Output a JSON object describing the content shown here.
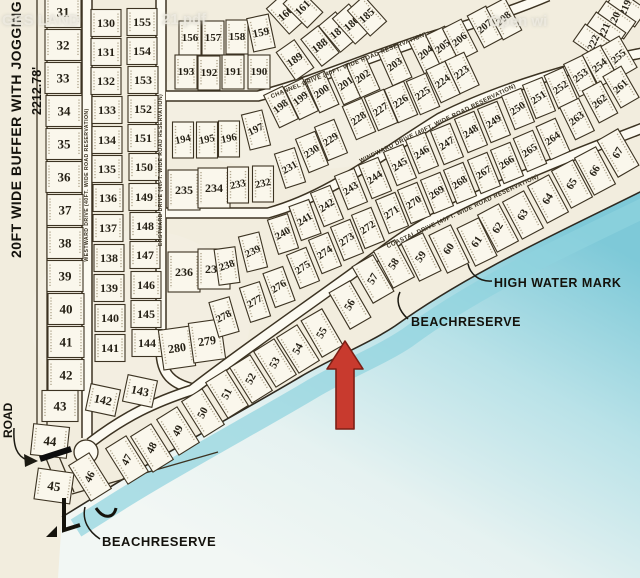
{
  "colors": {
    "paper": "#f2edde",
    "lot_fill": "#faf7ec",
    "road_fill": "#fcfaf1",
    "line": "#3c3322",
    "text": "#241f14",
    "water_deep": "#7ec9d8",
    "water_mid": "#b9e2e8",
    "water_light": "#e6f2f1",
    "water_pale": "#f2f7f4",
    "shore_band": "#8ed3de",
    "arrow_fill": "#c83a2e",
    "arrow_stroke": "#7c1f15"
  },
  "watermark": {
    "left": "GES LAND",
    "mid": "21.pdf",
    "right": "Open wi"
  },
  "labels": {
    "buffer": "20FT WIDE BUFFER WITH JOGGING T",
    "buffer_dim": "2212.78'",
    "road_left": "ROAD",
    "high_water_mark": "HIGH WATER MARK",
    "beach_reserve_right": "BEACHRESERVE",
    "beach_reserve_bottom": "BEACHRESERVE"
  },
  "roads": {
    "westward": "WESTWARD DRIVE (40FT. WIDE ROAD RESERVATION)",
    "eastward": "EASTWARD DRIVE (40FT. WIDE ROAD RESERVATION)",
    "channel": "CHANNEL DRIVE (40FT. WIDE ROAD RESERVATION)",
    "windward": "WINDWARD DRIVE (40FT. WIDE ROAD RESERVATION)",
    "coastal": "COASTAL DRIVE (40FT. WIDE ROAD RESERVATION)"
  },
  "lot_groups": [
    {
      "id": "column-west",
      "w": 36,
      "h": 31,
      "fs": 13,
      "tr": 0,
      "lots": [
        [
          31,
          63,
          12
        ],
        [
          32,
          63,
          45
        ],
        [
          33,
          63,
          78
        ],
        [
          34,
          64,
          111
        ],
        [
          35,
          64,
          144
        ],
        [
          36,
          64,
          177
        ],
        [
          37,
          65,
          210
        ],
        [
          38,
          65,
          243
        ],
        [
          39,
          65,
          276
        ],
        [
          40,
          66,
          309
        ],
        [
          41,
          66,
          342
        ],
        [
          42,
          66,
          375
        ],
        [
          43,
          60,
          406
        ],
        [
          44,
          50,
          441,
          6
        ],
        [
          45,
          54,
          486,
          8
        ]
      ]
    },
    {
      "id": "column-130s",
      "w": 30,
      "h": 27,
      "fs": 12,
      "tr": 0,
      "lots": [
        [
          130,
          106,
          23
        ],
        [
          131,
          106,
          52
        ],
        [
          132,
          106,
          81
        ],
        [
          133,
          107,
          110
        ],
        [
          134,
          107,
          140
        ],
        [
          135,
          107,
          169
        ],
        [
          136,
          108,
          198
        ],
        [
          137,
          108,
          228
        ],
        [
          138,
          109,
          258
        ],
        [
          139,
          109,
          288
        ],
        [
          140,
          110,
          318
        ],
        [
          141,
          110,
          348
        ],
        [
          142,
          103,
          400,
          12
        ]
      ]
    },
    {
      "id": "column-150s",
      "w": 30,
      "h": 27,
      "fs": 12,
      "tr": 0,
      "lots": [
        [
          155,
          142,
          22
        ],
        [
          154,
          142,
          51
        ],
        [
          153,
          143,
          80
        ],
        [
          152,
          143,
          109
        ],
        [
          151,
          143,
          138
        ],
        [
          150,
          144,
          167
        ],
        [
          149,
          144,
          197
        ],
        [
          148,
          145,
          226
        ],
        [
          147,
          145,
          255
        ],
        [
          146,
          146,
          285
        ],
        [
          145,
          146,
          314
        ],
        [
          144,
          147,
          343
        ],
        [
          143,
          140,
          391,
          12
        ]
      ]
    },
    {
      "id": "eastward-pairs",
      "w": 32,
      "h": 40,
      "fs": 12,
      "tr": 0,
      "lots": [
        [
          235,
          184,
          190
        ],
        [
          234,
          214,
          188
        ],
        [
          236,
          184,
          272
        ],
        [
          237,
          214,
          269
        ],
        [
          280,
          177,
          348,
          -8
        ],
        [
          279,
          207,
          341,
          -8
        ]
      ]
    },
    {
      "id": "band1-top",
      "w": 22,
      "h": 34,
      "fs": 11,
      "tr": 0,
      "lots": [
        [
          156,
          190,
          38
        ],
        [
          157,
          213,
          38
        ],
        [
          158,
          237,
          37
        ],
        [
          159,
          261,
          33,
          -12
        ],
        [
          160,
          286,
          14,
          -42
        ],
        [
          161,
          303,
          8,
          -45
        ]
      ]
    },
    {
      "id": "band1-bottom",
      "w": 22,
      "h": 34,
      "fs": 11,
      "tr": 0,
      "lots": [
        [
          193,
          186,
          72
        ],
        [
          192,
          209,
          73
        ],
        [
          191,
          233,
          72
        ],
        [
          190,
          259,
          72
        ],
        [
          189,
          295,
          60,
          -35
        ],
        [
          188,
          320,
          46,
          -38
        ],
        [
          187,
          338,
          32,
          -40
        ],
        [
          186,
          352,
          24,
          -42
        ],
        [
          185,
          367,
          16,
          -42
        ]
      ]
    },
    {
      "id": "band2-top",
      "w": 21,
      "h": 36,
      "fs": 10.5,
      "tr": -12,
      "lots": [
        [
          194,
          183,
          140
        ],
        [
          195,
          207,
          140
        ],
        [
          196,
          229,
          139
        ],
        [
          197,
          256,
          130,
          -14
        ],
        [
          198,
          281,
          107,
          -26
        ],
        [
          199,
          301,
          99,
          -26
        ],
        [
          200,
          322,
          92,
          -24
        ],
        [
          201,
          346,
          84,
          -24
        ],
        [
          202,
          363,
          77,
          -24
        ],
        [
          203,
          395,
          65,
          -24
        ],
        [
          204,
          426,
          53,
          -26
        ],
        [
          205,
          443,
          47,
          -26
        ],
        [
          206,
          460,
          40,
          -27
        ],
        [
          207,
          485,
          27,
          -28
        ],
        [
          208,
          504,
          19,
          -28
        ],
        [
          219,
          626,
          8,
          -55
        ],
        [
          220,
          615,
          20,
          -55
        ],
        [
          221,
          605,
          31,
          -55
        ],
        [
          222,
          594,
          43,
          -55
        ]
      ]
    },
    {
      "id": "band2-bottom",
      "w": 21,
      "h": 36,
      "fs": 10.5,
      "tr": -12,
      "lots": [
        [
          223,
          462,
          73,
          -25
        ],
        [
          224,
          443,
          82,
          -25
        ],
        [
          225,
          423,
          94,
          -23
        ],
        [
          226,
          401,
          102,
          -23
        ],
        [
          227,
          381,
          110,
          -23
        ],
        [
          228,
          359,
          119,
          -23
        ],
        [
          229,
          331,
          140,
          -22
        ],
        [
          230,
          312,
          152,
          -22
        ],
        [
          231,
          290,
          168,
          -18
        ]
      ]
    },
    {
      "id": "band3-top",
      "w": 21,
      "h": 36,
      "fs": 10.5,
      "tr": -12,
      "lots": [
        [
          233,
          238,
          185
        ],
        [
          232,
          263,
          184
        ],
        [
          239,
          253,
          252,
          -14
        ],
        [
          238,
          227,
          266,
          -8
        ],
        [
          240,
          283,
          234,
          -18
        ],
        [
          241,
          305,
          220,
          -20
        ],
        [
          242,
          327,
          206,
          -22
        ],
        [
          243,
          351,
          189,
          -22
        ],
        [
          244,
          375,
          178,
          -22
        ],
        [
          245,
          400,
          165,
          -22
        ],
        [
          246,
          422,
          153,
          -22
        ],
        [
          247,
          447,
          144,
          -22
        ],
        [
          248,
          471,
          132,
          -22
        ],
        [
          249,
          494,
          122,
          -22
        ],
        [
          250,
          518,
          109,
          -22
        ],
        [
          251,
          539,
          98,
          -22
        ],
        [
          252,
          561,
          88,
          -24
        ],
        [
          253,
          581,
          76,
          -26
        ],
        [
          254,
          600,
          66,
          -28
        ],
        [
          255,
          619,
          57,
          -30
        ]
      ]
    },
    {
      "id": "band3-bottom",
      "w": 21,
      "h": 36,
      "fs": 10.5,
      "tr": -12,
      "lots": [
        [
          278,
          224,
          317,
          -16
        ],
        [
          277,
          255,
          302,
          -18
        ],
        [
          276,
          279,
          287,
          -20
        ],
        [
          275,
          303,
          268,
          -22
        ],
        [
          274,
          325,
          253,
          -22
        ],
        [
          273,
          347,
          240,
          -22
        ],
        [
          272,
          368,
          228,
          -22
        ],
        [
          271,
          392,
          213,
          -22
        ],
        [
          270,
          414,
          203,
          -22
        ],
        [
          269,
          437,
          193,
          -22
        ],
        [
          268,
          460,
          183,
          -22
        ],
        [
          267,
          484,
          173,
          -22
        ],
        [
          266,
          507,
          163,
          -22
        ],
        [
          265,
          530,
          151,
          -23
        ],
        [
          264,
          553,
          139,
          -24
        ],
        [
          263,
          577,
          119,
          -26
        ],
        [
          262,
          600,
          102,
          -28
        ],
        [
          261,
          621,
          87,
          -30
        ]
      ]
    },
    {
      "id": "beach-row",
      "w": 24,
      "h": 42,
      "fs": 11,
      "tr": -30,
      "lots": [
        [
          46,
          90,
          477,
          -32
        ],
        [
          47,
          127,
          460,
          -32
        ],
        [
          48,
          152,
          448,
          -32
        ],
        [
          49,
          178,
          431,
          -32
        ],
        [
          50,
          203,
          413,
          -32
        ],
        [
          51,
          227,
          394,
          -32
        ],
        [
          52,
          251,
          379,
          -32
        ],
        [
          53,
          275,
          363,
          -32
        ],
        [
          54,
          298,
          349,
          -32
        ],
        [
          55,
          322,
          333,
          -30
        ],
        [
          56,
          350,
          305,
          -30
        ],
        [
          57,
          373,
          279,
          -30
        ],
        [
          58,
          394,
          264,
          -28
        ],
        [
          59,
          421,
          257,
          -26
        ],
        [
          60,
          449,
          249,
          -26
        ],
        [
          61,
          477,
          242,
          -26
        ],
        [
          62,
          498,
          228,
          -28
        ],
        [
          63,
          523,
          215,
          -28
        ],
        [
          64,
          548,
          199,
          -28
        ],
        [
          65,
          572,
          184,
          -28
        ],
        [
          66,
          595,
          171,
          -28
        ],
        [
          67,
          618,
          153,
          -30
        ]
      ]
    }
  ]
}
